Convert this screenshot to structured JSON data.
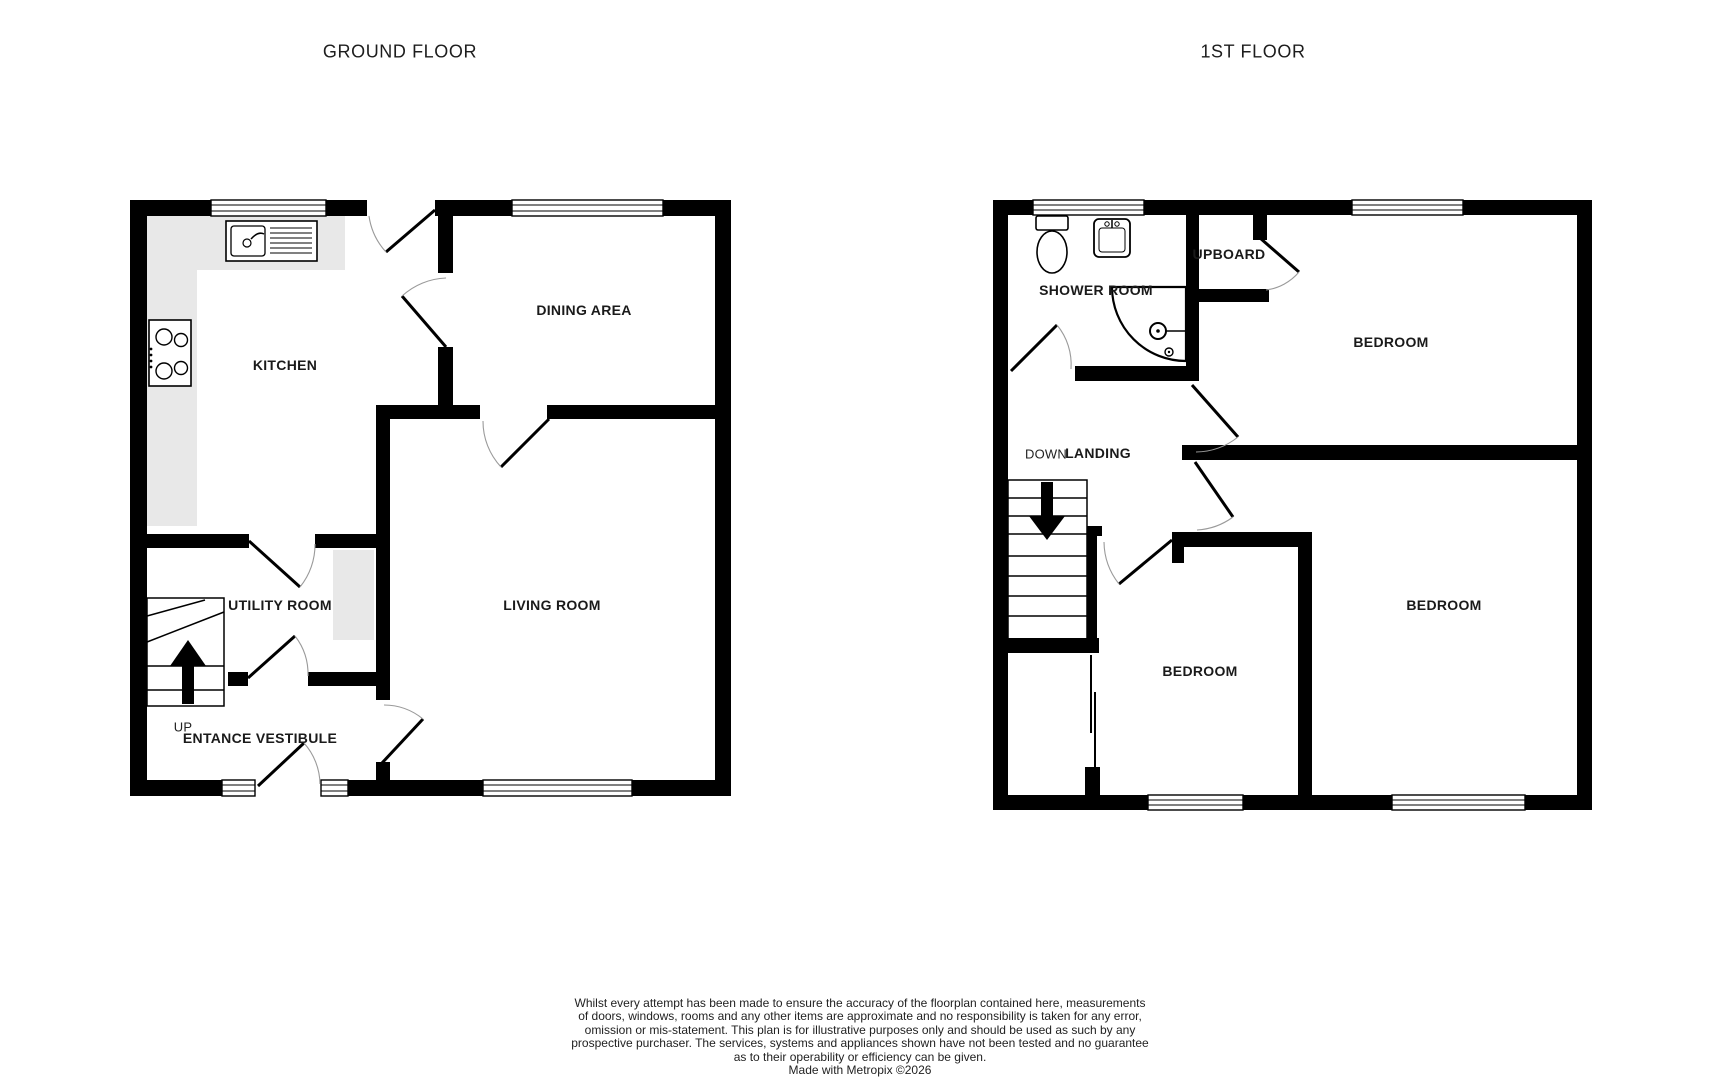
{
  "titles": {
    "ground": "GROUND FLOOR",
    "first": "1ST FLOOR"
  },
  "ground_floor": {
    "kitchen": "KITCHEN",
    "dining_area": "DINING AREA",
    "living_room": "LIVING ROOM",
    "utility_room": "UTILITY ROOM",
    "vestibule": "ENTANCE VESTIBULE",
    "stairs_direction": "UP"
  },
  "first_floor": {
    "shower_room": "SHOWER ROOM",
    "cupboard": "UPBOARD",
    "bedroom_top": "BEDROOM",
    "bedroom_middle": "BEDROOM",
    "bedroom_right": "BEDROOM",
    "landing": "LANDING",
    "stairs_direction": "DOWN"
  },
  "footer": {
    "lines": [
      "Whilst every attempt has been made to ensure the accuracy of the floorplan contained here, measurements",
      "of doors, windows, rooms and any other items are approximate and no responsibility is taken for any error,",
      "omission or mis-statement. This plan is for illustrative purposes only and should be used as such by any",
      "prospective purchaser. The services, systems and appliances shown have not been tested and no guarantee",
      "as to their operability or efficiency can be given.",
      "Made with Metropix ©2026"
    ]
  },
  "colors": {
    "wall": "#000000",
    "counter": "#e8e8e8",
    "door_arc": "#9a9a9a"
  }
}
